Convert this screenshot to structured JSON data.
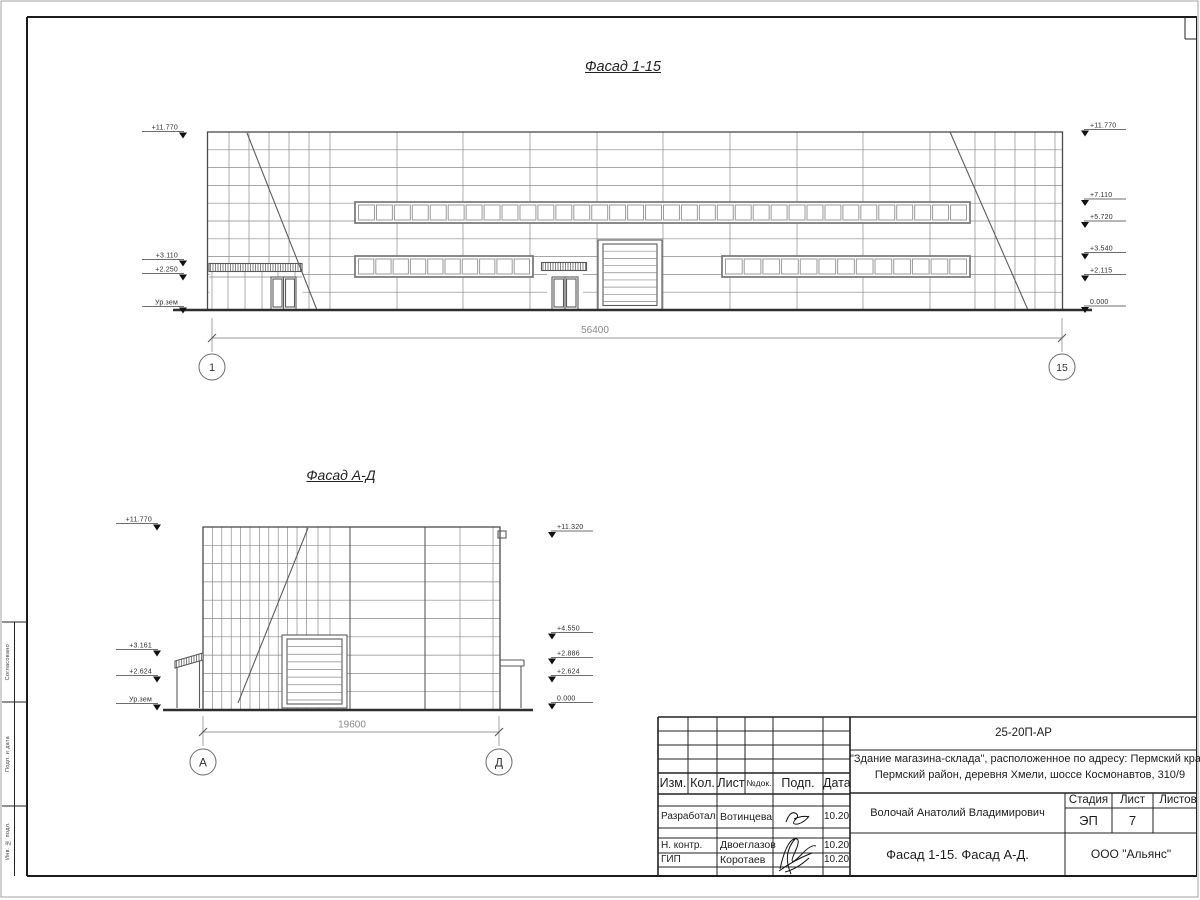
{
  "colors": {
    "ink": "#3a3a3a",
    "paper": "#ffffff",
    "line_gray": "#8a8a8a"
  },
  "titles": {
    "facade1": "Фасад 1-15",
    "facade2": "Фасад А-Д"
  },
  "facade1": {
    "dimension": "56400",
    "axes": {
      "left": "1",
      "right": "15"
    },
    "marks_left": [
      "+11.770",
      "+3.110",
      "+2.250",
      "Ур.зем"
    ],
    "marks_right": [
      "+11.770",
      "+7.110",
      "+5.720",
      "+3.540",
      "+2.115",
      "0.000"
    ]
  },
  "facade2": {
    "dimension": "19600",
    "axes": {
      "left": "А",
      "right": "Д"
    },
    "marks_left": [
      "+11.770",
      "+3.161",
      "+2.624",
      "Ур.зем"
    ],
    "marks_right": [
      "+11.320",
      "+4.550",
      "+2.886",
      "+2.624",
      "0.000"
    ]
  },
  "titleblock": {
    "doc_code": "25-20П-АР",
    "project_line1": "\"Здание магазина-склада\", расположенное по адресу: Пермский край,",
    "project_line2": "Пермский район, деревня Хмели, шоссе Космонавтов, 310/9",
    "columns": {
      "izm": "Изм.",
      "kol": "Кол.",
      "list": "Лист",
      "ndok": "№док.",
      "podp": "Подп.",
      "data": "Дата"
    },
    "rows": [
      {
        "role": "Разработал",
        "name": "Вотинцева",
        "date": "10.20"
      },
      {
        "role": "Н. контр.",
        "name": "Двоеглазов",
        "date": "10.20"
      },
      {
        "role": "ГИП",
        "name": "Коротаев",
        "date": "10.20"
      }
    ],
    "approver": "Волочай Анатолий Владимирович",
    "stage_header": {
      "stage": "Стадия",
      "sheet": "Лист",
      "sheets": "Листов"
    },
    "stage_value": "ЭП",
    "sheet_value": "7",
    "drawing_title": "Фасад 1-15. Фасад А-Д.",
    "company": "ООО \"Альянс\""
  },
  "side_strip": {
    "labels": [
      "Согласовано",
      "Подп. и дата",
      "Инв. № подл."
    ]
  }
}
